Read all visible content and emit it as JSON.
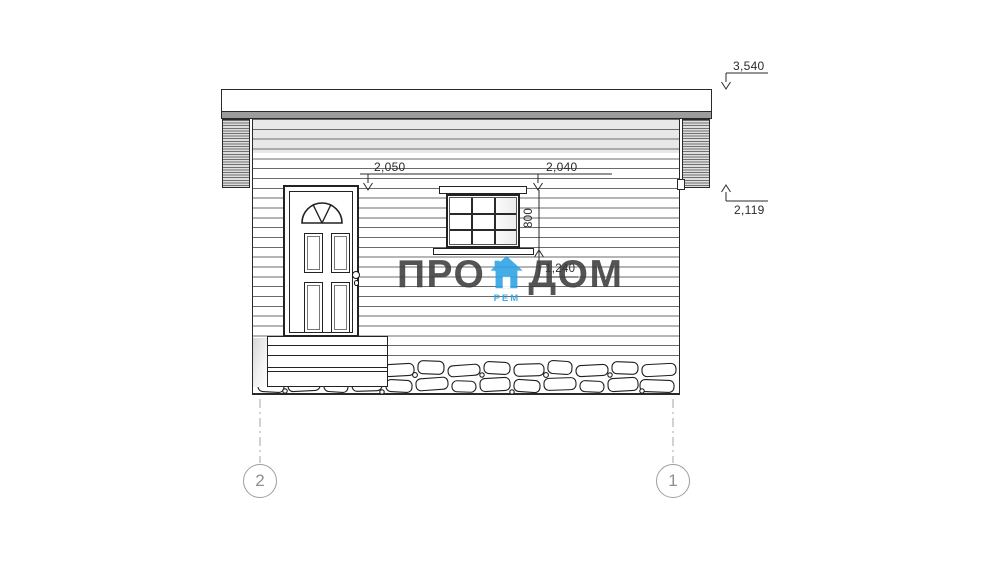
{
  "watermark": {
    "pro": "ПРО",
    "dom": "ДОМ",
    "rem": "РЕМ"
  },
  "levels": {
    "roof_top": "3,540",
    "eaves": "2,119"
  },
  "dimensions": {
    "door_top": "2,050",
    "window_top": "2,040",
    "window_height": "800",
    "window_sill": "1,240"
  },
  "axes": {
    "left_label": "2",
    "right_label": "1"
  },
  "colors": {
    "accent_blue": "#2ba1e3",
    "watermark_gray": "#3d3d3d",
    "line_dark": "#2a2a2a",
    "siding_gray": "#e8e8e8",
    "drip_edge_gray": "#9c9c9c",
    "axis_gray": "#9e9e9e"
  }
}
